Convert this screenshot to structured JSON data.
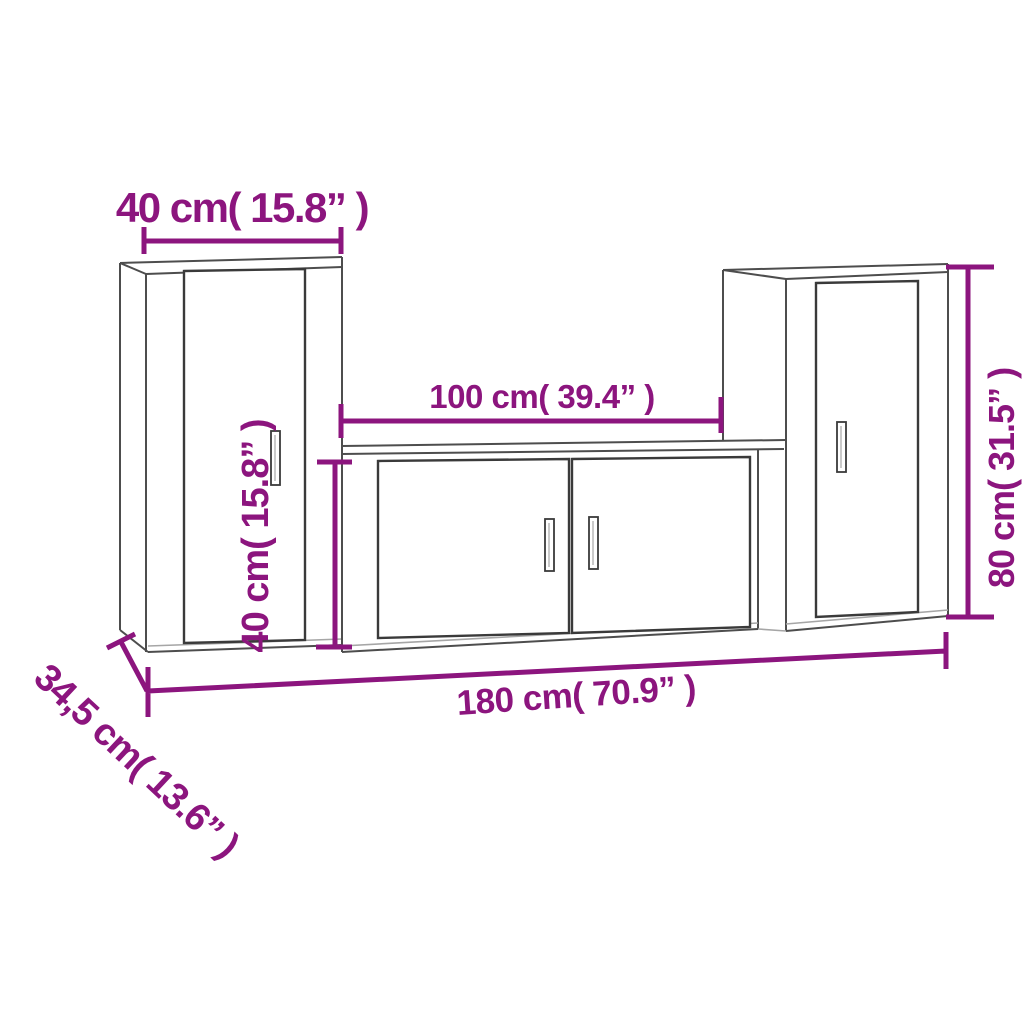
{
  "colors": {
    "accent": "#8C157E",
    "edge": "#4d4d4d",
    "edge_light": "#a6a6a6",
    "door": "#3a3a3a",
    "background": "#ffffff"
  },
  "dimensions": {
    "top_width": {
      "label": "40 cm( 15.8” )"
    },
    "middle_width": {
      "label": "100 cm( 39.4” )"
    },
    "center_height": {
      "label": "40 cm( 15.8” )"
    },
    "right_height": {
      "label": "80 cm( 31.5” )"
    },
    "total_width": {
      "label": "180 cm( 70.9” )"
    },
    "depth": {
      "label": "34,5 cm( 13.6” )"
    }
  }
}
